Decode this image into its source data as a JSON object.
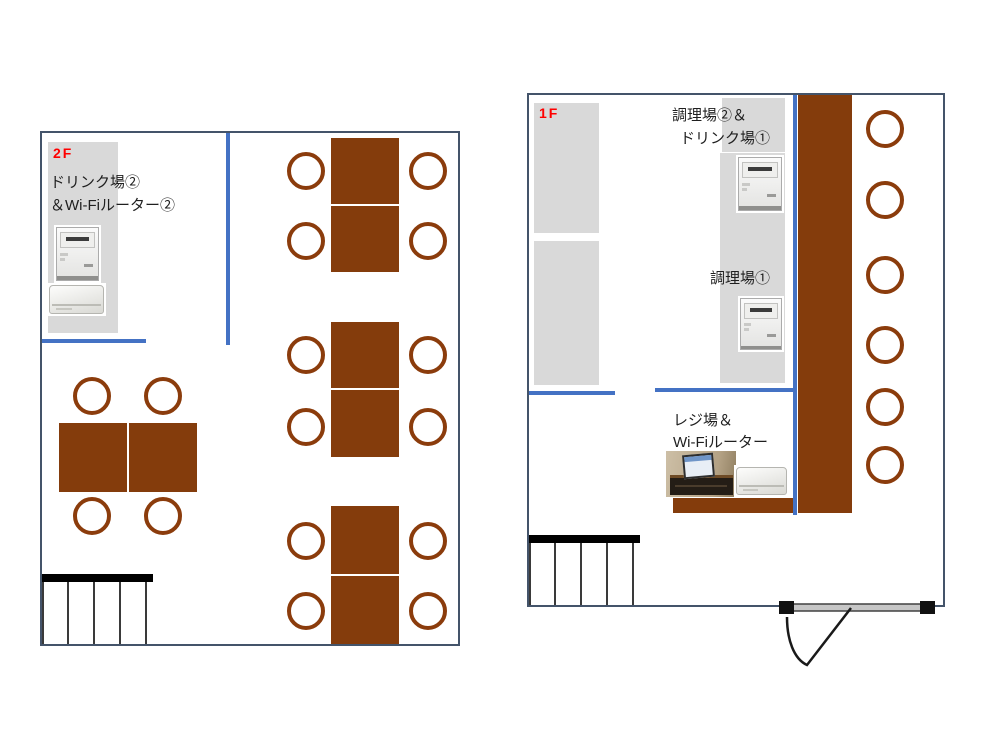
{
  "diagram": {
    "type": "restaurant-floor-plan",
    "colors": {
      "table_brown": "#843C0C",
      "chair_outline_brown": "#8B3C0C",
      "interior_wall_blue": "#4472C4",
      "area_gray": "#D9D9D9",
      "room_outline_slate": "#44546A",
      "floor_label_red": "#FF0000"
    }
  },
  "floor_2f": {
    "floor_label": "2F",
    "drink_area_label_line1": "ドリンク場②",
    "drink_area_label_line2": "＆Wi-Fiルーター②",
    "equipment": [
      {
        "name": "receipt-printer"
      },
      {
        "name": "wifi-router"
      }
    ],
    "table_count": 8,
    "chair_count": 16
  },
  "floor_1f": {
    "floor_label": "1F",
    "kitchen2_drink1_label_line1": "調理場②＆",
    "kitchen2_drink1_label_line2": "ドリンク場①",
    "kitchen1_label": "調理場①",
    "register_label_line1": "レジ場＆",
    "register_label_line2": "Wi-Fiルーター",
    "equipment": [
      {
        "name": "receipt-printer"
      },
      {
        "name": "receipt-printer"
      },
      {
        "name": "pos-register"
      },
      {
        "name": "wifi-router"
      }
    ],
    "counter_stool_count": 6
  }
}
